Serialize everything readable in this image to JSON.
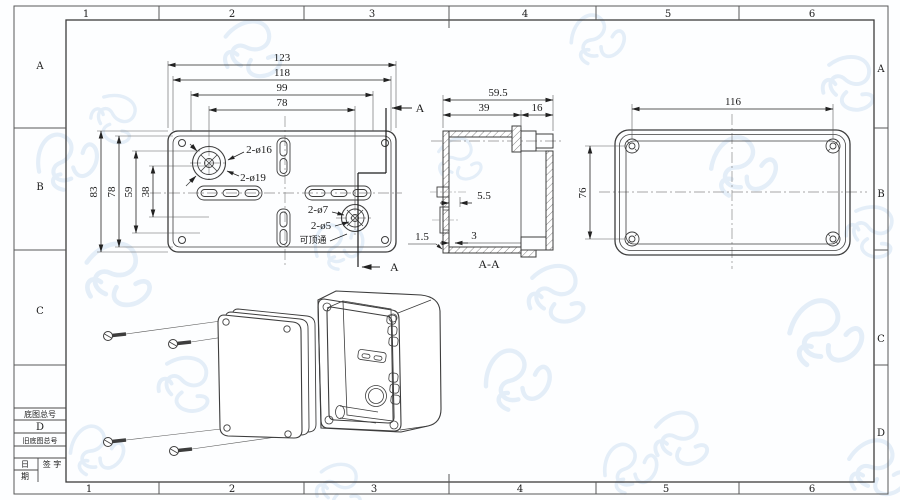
{
  "sheet": {
    "grid_top": [
      "1",
      "2",
      "3",
      "4",
      "5",
      "6"
    ],
    "grid_bottom": [
      "1",
      "2",
      "3",
      "4",
      "5",
      "6"
    ],
    "grid_left": [
      "A",
      "B",
      "C"
    ],
    "grid_right": [
      "A",
      "B",
      "C",
      "D"
    ],
    "title_block": {
      "drawing_no_label": "底图总号",
      "size_letter": "D",
      "old_no_label": "旧底图总号",
      "date_char_top": "日",
      "date_char_bottom": "期",
      "sign_label": "签 字"
    }
  },
  "top_view": {
    "dims": {
      "w1": "123",
      "w2": "118",
      "w3": "99",
      "w4": "78",
      "h1": "83",
      "h2": "78",
      "h3": "59",
      "h4": "38"
    },
    "labels": {
      "k16": "2-ø16",
      "k19": "2-ø19",
      "k7": "2-ø7",
      "k5": "2-ø5",
      "note": "可顶通"
    },
    "section_letter": "A"
  },
  "section_view": {
    "dims": {
      "d1": "59.5",
      "d2": "39",
      "d3": "16",
      "d4": "5.5",
      "d5": "3",
      "d6": "1.5"
    },
    "label": "A-A"
  },
  "end_view": {
    "dims": {
      "w": "116",
      "h": "76"
    }
  }
}
